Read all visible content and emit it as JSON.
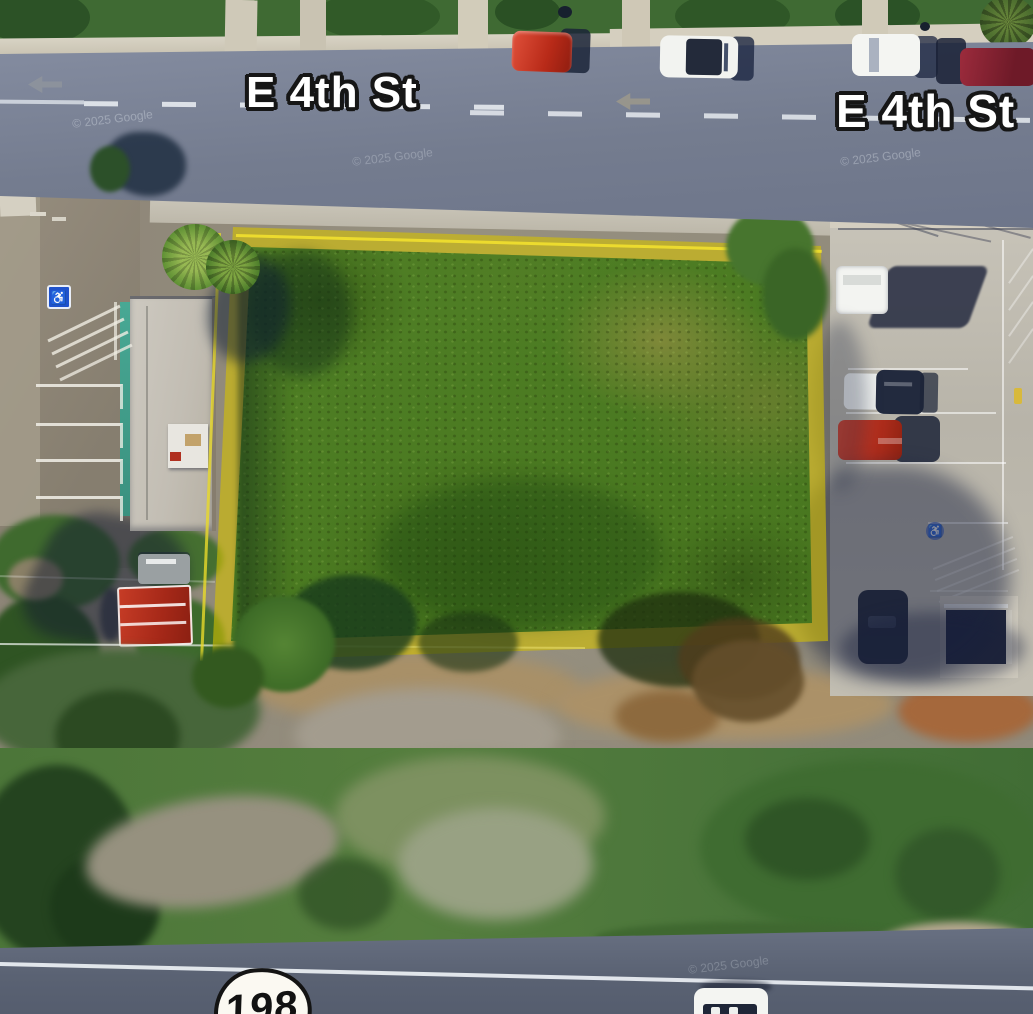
{
  "map": {
    "type": "satellite-aerial-parcel-view",
    "street_labels": [
      {
        "text": "E 4th St"
      },
      {
        "text": "E 4th St"
      }
    ],
    "route_shield": {
      "number": "198"
    },
    "watermarks": [
      {
        "text": "© 2025 Google"
      },
      {
        "text": "© 2025 Google"
      },
      {
        "text": "© 2025 Google"
      },
      {
        "text": "© 2025 Google"
      }
    ],
    "icons": {
      "accessible_parking": "♿",
      "direction_arrow": "left-arrow"
    },
    "parcel_highlight": {
      "outline_color": "#d8c400",
      "fill_description": "translucent yellow boundary band over vacant green lot"
    },
    "colors": {
      "parcel_outline": "#d8c400",
      "top_road": "#7b8395",
      "bottom_road": "#5e6677",
      "vegetation": "#3e7a27",
      "concrete_lot": "#bcb8ae",
      "label_fill": "#ffffff",
      "label_stroke": "#161616"
    }
  }
}
